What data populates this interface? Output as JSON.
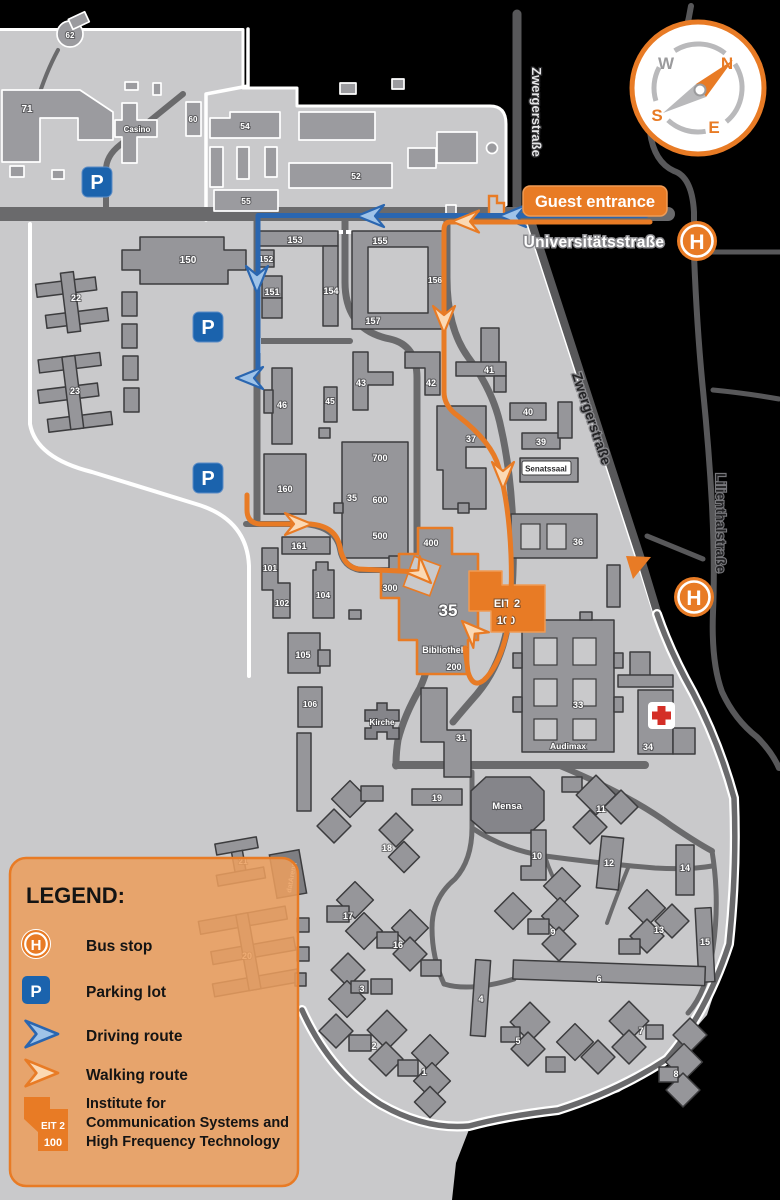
{
  "banner": {
    "guest_entrance": "Guest entrance"
  },
  "streets": {
    "universitaetsstrasse": "Universitätsstraße",
    "zwergerstrasse_top": "Zwergerstraße",
    "zwergerstrasse_diag": "Zwergerstraße",
    "lilienthalstrasse": "Lilienthalstraße"
  },
  "compass": {
    "n": "N",
    "e": "E",
    "s": "S",
    "w": "W"
  },
  "icons": {
    "bus_stop": "H",
    "parking": "P"
  },
  "institute_badge": {
    "line1": "EIT 2",
    "line2": "100"
  },
  "legend": {
    "title": "LEGEND:",
    "items": [
      {
        "id": "bus-stop",
        "label": "Bus stop"
      },
      {
        "id": "parking-lot",
        "label": "Parking lot"
      },
      {
        "id": "driving-route",
        "label": "Driving route"
      },
      {
        "id": "walking-route",
        "label": "Walking route"
      }
    ],
    "institute_lines": [
      "Institute for",
      "Communication Systems and",
      "High Frequency Technology"
    ]
  },
  "buildings": {
    "b71": "71",
    "b62": "62",
    "casino": "Casino",
    "b60": "60",
    "b54": "54",
    "b55": "55",
    "b52": "52",
    "b150": "150",
    "b22": "22",
    "b23": "23",
    "b153": "153",
    "b152": "152",
    "b151": "151",
    "b154": "154",
    "b155": "155",
    "b156": "156",
    "b157": "157",
    "b46": "46",
    "b45": "45",
    "b43": "43",
    "b42": "42",
    "b41": "41",
    "b40": "40",
    "b39": "39",
    "senatssaal": "Senatssaal",
    "b37": "37",
    "b36": "36",
    "b35big": "35",
    "b700": "700",
    "b600": "600",
    "b500": "500",
    "b400": "400",
    "b300": "300",
    "b200": "200",
    "b35": "35",
    "bibliothek": "Bibliothek",
    "b160": "160",
    "b161": "161",
    "b101": "101",
    "b102": "102",
    "b104": "104",
    "b105": "105",
    "b106": "106",
    "kirche": "Kirche",
    "b31": "31",
    "b33": "33",
    "audimax": "Audimax",
    "b34": "34",
    "b19": "19",
    "mensa": "Mensa",
    "b18": "18",
    "b17": "17",
    "b16": "16",
    "b11": "11",
    "b10": "10",
    "b12": "12",
    "b14": "14",
    "b9": "9",
    "b13": "13",
    "b15": "15",
    "b6": "6",
    "b4": "4",
    "b5": "5",
    "b7": "7",
    "b8": "8",
    "b3": "3",
    "b2": "2",
    "b1": "1",
    "b20": "20",
    "b21": "21",
    "datarena": "datArena"
  },
  "colors": {
    "accent_orange": "#e87b25",
    "route_blue": "#2a66b0",
    "parking_blue": "#1b63ad",
    "campus_gray": "#c9c9cb",
    "building_gray": "#96969a",
    "medical_red": "#d42f27"
  }
}
